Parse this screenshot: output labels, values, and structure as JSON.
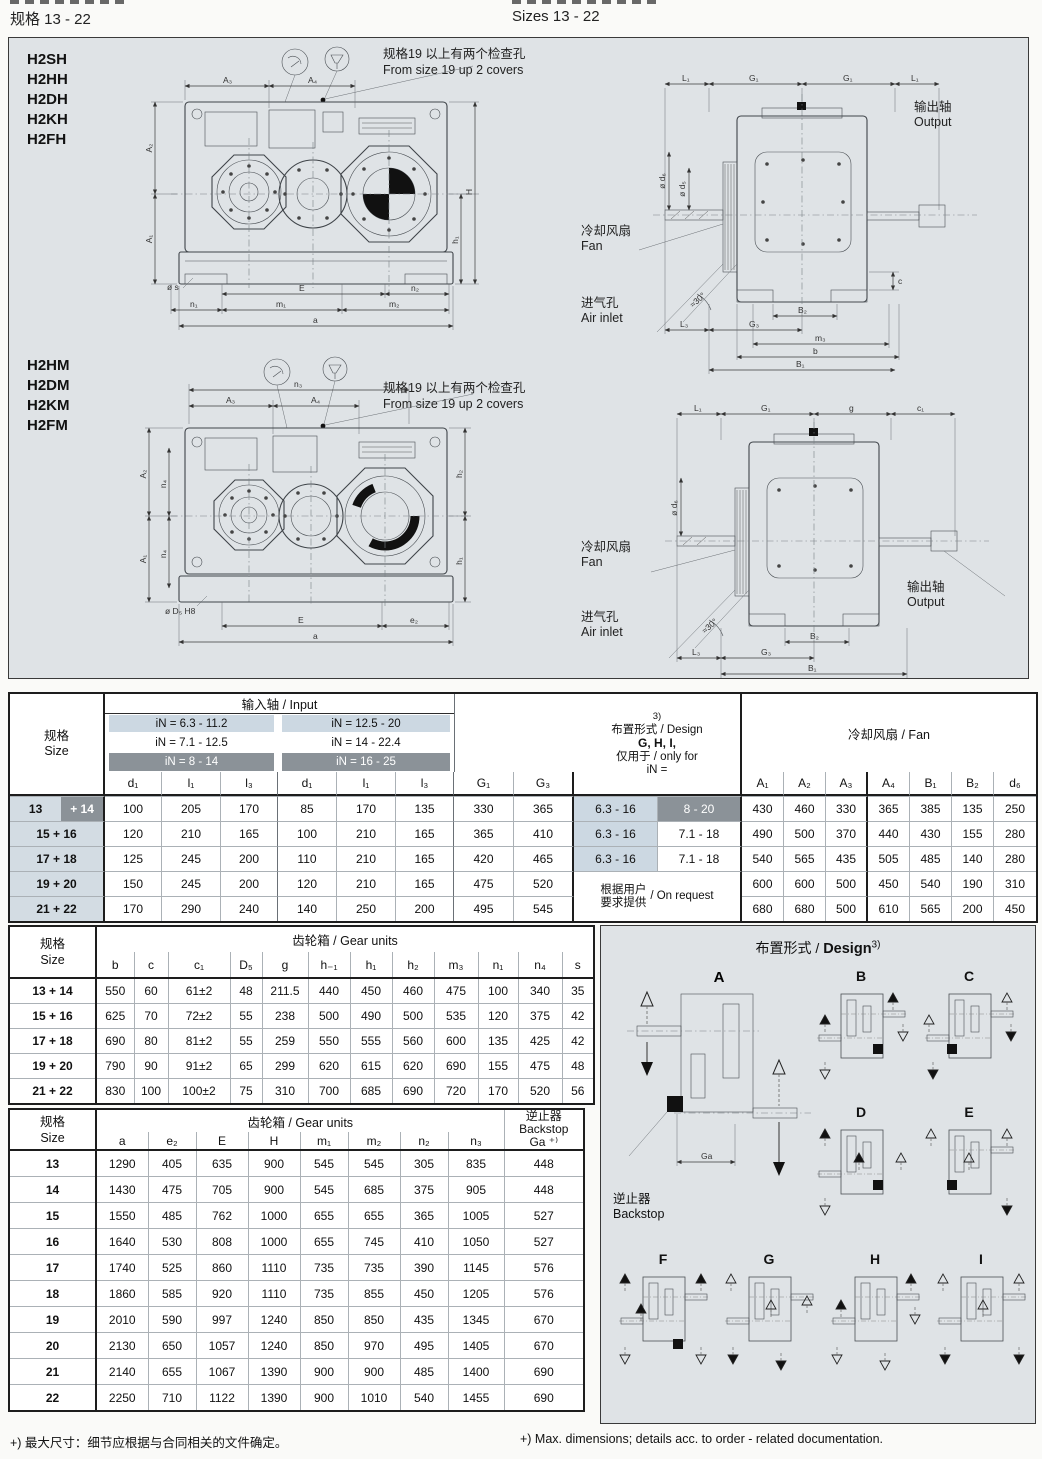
{
  "page": {
    "header_left": "规格 13 - 22",
    "header_right": "Sizes 13 - 22",
    "footnote_cn": "+) 最大尺寸：细节应根据与合同相关的文件确定。",
    "footnote_en": "+) Max. dimensions; details acc. to order - related documentation."
  },
  "drawing": {
    "models_top": [
      "H2SH",
      "H2HH",
      "H2DH",
      "H2KH",
      "H2FH"
    ],
    "models_bottom": [
      "H2HM",
      "H2DM",
      "H2KM",
      "H2FM"
    ],
    "note_cn": "规格19 以上有两个检查孔",
    "note_en": "From size 19 up 2 covers",
    "output_cn": "输出轴",
    "output_en": "Output",
    "fan_cn": "冷却风扇",
    "fan_en": "Fan",
    "air_cn": "进气孔",
    "air_en": "Air inlet",
    "front_top_dims": [
      "A₃",
      "A₄",
      "A₂",
      "A₁",
      "H",
      "h₁",
      "ø s",
      "E",
      "n₂",
      "n₁",
      "m₁",
      "m₂",
      "a"
    ],
    "side_top_dims": [
      "L₁",
      "G₁",
      "G₁",
      "L₁",
      "ø d₅",
      "ø d₆",
      "c",
      "≈30°",
      "B₂",
      "L₃",
      "G₃",
      "m₃",
      "b",
      "B₁"
    ],
    "front_bottom_dims": [
      "n₃",
      "A₃",
      "A₄",
      "A₂",
      "n₄",
      "A₁",
      "n₄",
      "ø D₅ H8",
      "E",
      "e₂",
      "a",
      "h₂",
      "h₁"
    ],
    "side_bottom_dims": [
      "L₁",
      "G₁",
      "g",
      "c₁",
      "ø d₆",
      "≈30°",
      "B₂",
      "L₃",
      "G₃",
      "B₁"
    ]
  },
  "t1": {
    "header": {
      "size_cn": "规格",
      "size_en": "Size",
      "input_title": "输入轴 / Input",
      "in_rows": [
        [
          "iN = 6.3 - 11.2",
          "iN = 12.5 - 20"
        ],
        [
          "iN = 7.1 - 12.5",
          "iN = 14 - 22.4"
        ],
        [
          "iN = 8 - 14",
          "iN = 16 - 25"
        ]
      ],
      "cols": [
        "d₁",
        "l₁",
        "l₃",
        "d₁",
        "l₁",
        "l₃",
        "G₁",
        "G₃"
      ],
      "design_sup": "3)",
      "design_l1": "布置形式 / Design",
      "design_l2": "G, H, I,",
      "design_l3": "仅用于 / only for",
      "design_l4": "iN =",
      "fan_title": "冷却风扇 / Fan",
      "fan_cols": [
        "A₁",
        "A₂",
        "A₃",
        "A₄",
        "B₁",
        "B₂",
        "d₆"
      ]
    },
    "rows": [
      {
        "size": "13",
        "size2": "+ 14",
        "vals": [
          "100",
          "205",
          "170",
          "85",
          "170",
          "135",
          "330",
          "365"
        ],
        "design": [
          "6.3 - 16",
          "8 - 20"
        ],
        "design_dark2": true,
        "fan": [
          "430",
          "460",
          "330",
          "365",
          "385",
          "135",
          "250"
        ]
      },
      {
        "size": "15 + 16",
        "vals": [
          "120",
          "210",
          "165",
          "100",
          "210",
          "165",
          "365",
          "410"
        ],
        "design": [
          "6.3 - 16",
          "7.1 - 18"
        ],
        "fan": [
          "490",
          "500",
          "370",
          "440",
          "430",
          "155",
          "280"
        ]
      },
      {
        "size": "17 + 18",
        "vals": [
          "125",
          "245",
          "200",
          "110",
          "210",
          "165",
          "420",
          "465"
        ],
        "design": [
          "6.3 - 16",
          "7.1 - 18"
        ],
        "fan": [
          "540",
          "565",
          "435",
          "505",
          "485",
          "140",
          "280"
        ]
      },
      {
        "size": "19 + 20",
        "vals": [
          "150",
          "245",
          "200",
          "120",
          "210",
          "165",
          "475",
          "520"
        ],
        "design_merged": {
          "cn1": "根据用户",
          "cn2": "要求提供",
          "en": "/ On request"
        },
        "fan": [
          "600",
          "600",
          "500",
          "450",
          "540",
          "190",
          "310"
        ]
      },
      {
        "size": "21 + 22",
        "vals": [
          "170",
          "290",
          "240",
          "140",
          "250",
          "200",
          "495",
          "545"
        ],
        "fan": [
          "680",
          "680",
          "500",
          "610",
          "565",
          "200",
          "450"
        ]
      }
    ]
  },
  "t2": {
    "header": {
      "size_cn": "规格",
      "size_en": "Size",
      "group": "齿轮箱 / Gear units",
      "cols": [
        "b",
        "c",
        "c₁",
        "D₅",
        "g",
        "h₋₁",
        "h₁",
        "h₂",
        "m₃",
        "n₁",
        "n₄",
        "s"
      ]
    },
    "rows": [
      {
        "size": "13 + 14",
        "vals": [
          "550",
          "60",
          "61±2",
          "48",
          "211.5",
          "440",
          "450",
          "460",
          "475",
          "100",
          "340",
          "35"
        ]
      },
      {
        "size": "15 + 16",
        "vals": [
          "625",
          "70",
          "72±2",
          "55",
          "238",
          "500",
          "490",
          "500",
          "535",
          "120",
          "375",
          "42"
        ]
      },
      {
        "size": "17 + 18",
        "vals": [
          "690",
          "80",
          "81±2",
          "55",
          "259",
          "550",
          "555",
          "560",
          "600",
          "135",
          "425",
          "42"
        ]
      },
      {
        "size": "19 + 20",
        "vals": [
          "790",
          "90",
          "91±2",
          "65",
          "299",
          "620",
          "615",
          "620",
          "690",
          "155",
          "475",
          "48"
        ]
      },
      {
        "size": "21 + 22",
        "vals": [
          "830",
          "100",
          "100±2",
          "75",
          "310",
          "700",
          "685",
          "690",
          "720",
          "170",
          "520",
          "56"
        ]
      }
    ]
  },
  "t3": {
    "header": {
      "size_cn": "规格",
      "size_en": "Size",
      "group": "齿轮箱 / Gear units",
      "cols": [
        "a",
        "e₂",
        "E",
        "H",
        "m₁",
        "m₂",
        "n₂",
        "n₃"
      ],
      "backstop_cn": "逆止器",
      "backstop_en": "Backstop",
      "backstop_sym": "Ga ⁺⁾"
    },
    "rows": [
      {
        "size": "13",
        "vals": [
          "1290",
          "405",
          "635",
          "900",
          "545",
          "545",
          "305",
          "835"
        ],
        "backstop": "448"
      },
      {
        "size": "14",
        "vals": [
          "1430",
          "475",
          "705",
          "900",
          "545",
          "685",
          "375",
          "905"
        ],
        "backstop": "448"
      },
      {
        "size": "15",
        "vals": [
          "1550",
          "485",
          "762",
          "1000",
          "655",
          "655",
          "365",
          "1005"
        ],
        "backstop": "527"
      },
      {
        "size": "16",
        "vals": [
          "1640",
          "530",
          "808",
          "1000",
          "655",
          "745",
          "410",
          "1050"
        ],
        "backstop": "527"
      },
      {
        "size": "17",
        "vals": [
          "1740",
          "525",
          "860",
          "1110",
          "735",
          "735",
          "390",
          "1145"
        ],
        "backstop": "576"
      },
      {
        "size": "18",
        "vals": [
          "1860",
          "585",
          "920",
          "1110",
          "735",
          "855",
          "450",
          "1205"
        ],
        "backstop": "576"
      },
      {
        "size": "19",
        "vals": [
          "2010",
          "590",
          "997",
          "1240",
          "850",
          "850",
          "435",
          "1345"
        ],
        "backstop": "670"
      },
      {
        "size": "20",
        "vals": [
          "2130",
          "650",
          "1057",
          "1240",
          "850",
          "970",
          "495",
          "1405"
        ],
        "backstop": "670"
      },
      {
        "size": "21",
        "vals": [
          "2140",
          "655",
          "1067",
          "1390",
          "900",
          "900",
          "485",
          "1400"
        ],
        "backstop": "690"
      },
      {
        "size": "22",
        "vals": [
          "2250",
          "710",
          "1122",
          "1390",
          "900",
          "1010",
          "540",
          "1455"
        ],
        "backstop": "690"
      }
    ]
  },
  "design_panel": {
    "title_cn": "布置形式 /",
    "title_en": "Design",
    "title_sup": "3)",
    "letters": [
      "A",
      "B",
      "C",
      "D",
      "E",
      "F",
      "G",
      "H",
      "I"
    ],
    "backstop_cn": "逆止器",
    "backstop_en": "Backstop",
    "ga_label": "Ga"
  },
  "colors": {
    "panel_bg": "#dfe3e6",
    "highlight_light": "#ccd8e2",
    "highlight_dark": "#8b9298"
  }
}
